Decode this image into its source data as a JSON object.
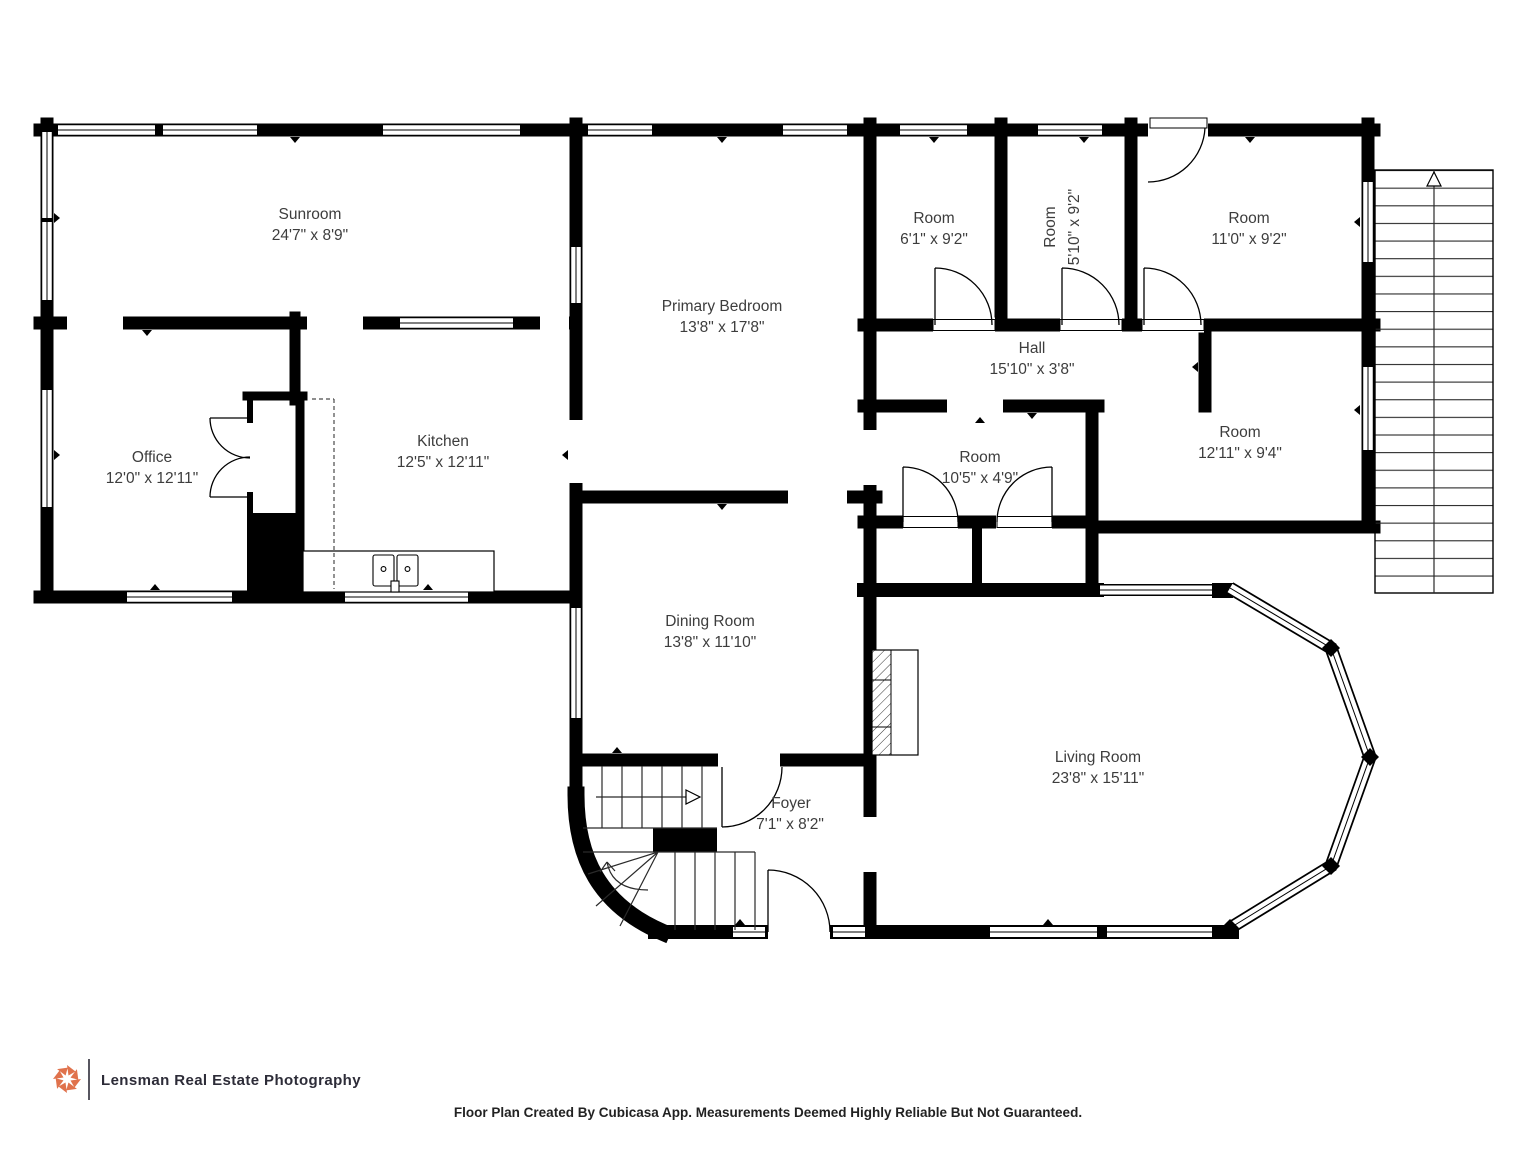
{
  "plan": {
    "rooms": [
      {
        "id": "sunroom",
        "name": "Sunroom",
        "dims": "24'7\" x 8'9\""
      },
      {
        "id": "primary-bedroom",
        "name": "Primary Bedroom",
        "dims": "13'8\" x 17'8\""
      },
      {
        "id": "room-small-1",
        "name": "Room",
        "dims": "6'1\" x 9'2\""
      },
      {
        "id": "room-small-2",
        "name": "Room",
        "dims": "5'10\" x 9'2\""
      },
      {
        "id": "room-top-right",
        "name": "Room",
        "dims": "11'0\" x 9'2\""
      },
      {
        "id": "hall",
        "name": "Hall",
        "dims": "15'10\" x 3'8\""
      },
      {
        "id": "office",
        "name": "Office",
        "dims": "12'0\" x 12'11\""
      },
      {
        "id": "kitchen",
        "name": "Kitchen",
        "dims": "12'5\" x 12'11\""
      },
      {
        "id": "room-middle",
        "name": "Room",
        "dims": "10'5\" x 4'9\""
      },
      {
        "id": "room-right",
        "name": "Room",
        "dims": "12'11\" x 9'4\""
      },
      {
        "id": "dining-room",
        "name": "Dining Room",
        "dims": "13'8\" x 11'10\""
      },
      {
        "id": "foyer",
        "name": "Foyer",
        "dims": "7'1\" x 8'2\""
      },
      {
        "id": "living-room",
        "name": "Living Room",
        "dims": "23'8\" x 15'11\""
      }
    ]
  },
  "footer": {
    "brand": "Lensman Real Estate Photography",
    "logo_icon": "aperture-icon"
  },
  "disclaimer": "Floor Plan Created By Cubicasa App. Measurements Deemed Highly Reliable But Not Guaranteed.",
  "colors": {
    "wall": "#000000",
    "label_text": "#3d3d3d",
    "brand_text": "#2d2c38",
    "logo_orange": "#e0724c"
  }
}
